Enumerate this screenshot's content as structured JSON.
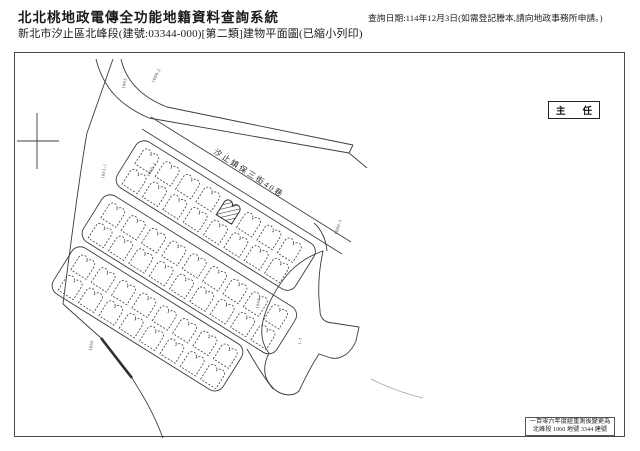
{
  "header": {
    "title": "北北桃地政電傳全功能地籍資料查詢系統",
    "subtitle": "新北市汐止區北峰段(建號:03344-000)[第二類]建物平面圖(已縮小列印)",
    "query_info": "查詢日期:114年12月3日(如需登記謄本,請向地政事務所申請。)"
  },
  "map": {
    "street_label": "汐止鎮保三街40巷",
    "stamp_left": "主",
    "stamp_right": "任",
    "note_lines": [
      "一百零六年度經重測後變更為",
      "北峰段 1060 地號 3344 建號"
    ],
    "subject_building_no": "3344",
    "colors": {
      "line": "#3c3c3c",
      "paper": "#ffffff",
      "text": "#1a1a1a"
    },
    "bands": [
      {
        "x": 140,
        "y": 136,
        "rot": 32,
        "len": 210,
        "h": 54,
        "units_per_row": 8,
        "hatched": {
          "row": 0,
          "index": 4
        }
      },
      {
        "x": 106,
        "y": 190,
        "rot": 32,
        "len": 228,
        "h": 54,
        "units_per_row": 9
      },
      {
        "x": 76,
        "y": 242,
        "rot": 32,
        "len": 200,
        "h": 54,
        "units_per_row": 8
      }
    ],
    "parcel_labels": [
      {
        "text": "1063",
        "x": 124,
        "y": 88,
        "rot": -82
      },
      {
        "text": "1060-2",
        "x": 153,
        "y": 82,
        "rot": -64
      },
      {
        "text": "1061-1",
        "x": 103,
        "y": 178,
        "rot": -80
      },
      {
        "text": "1060-1",
        "x": 148,
        "y": 176,
        "rot": -62
      },
      {
        "text": "1060-3",
        "x": 336,
        "y": 234,
        "rot": -72
      },
      {
        "text": "1064",
        "x": 258,
        "y": 308,
        "rot": -84
      },
      {
        "text": "1065",
        "x": 91,
        "y": 350,
        "rot": -84
      },
      {
        "text": "1-7",
        "x": 300,
        "y": 344,
        "rot": -80
      }
    ]
  }
}
